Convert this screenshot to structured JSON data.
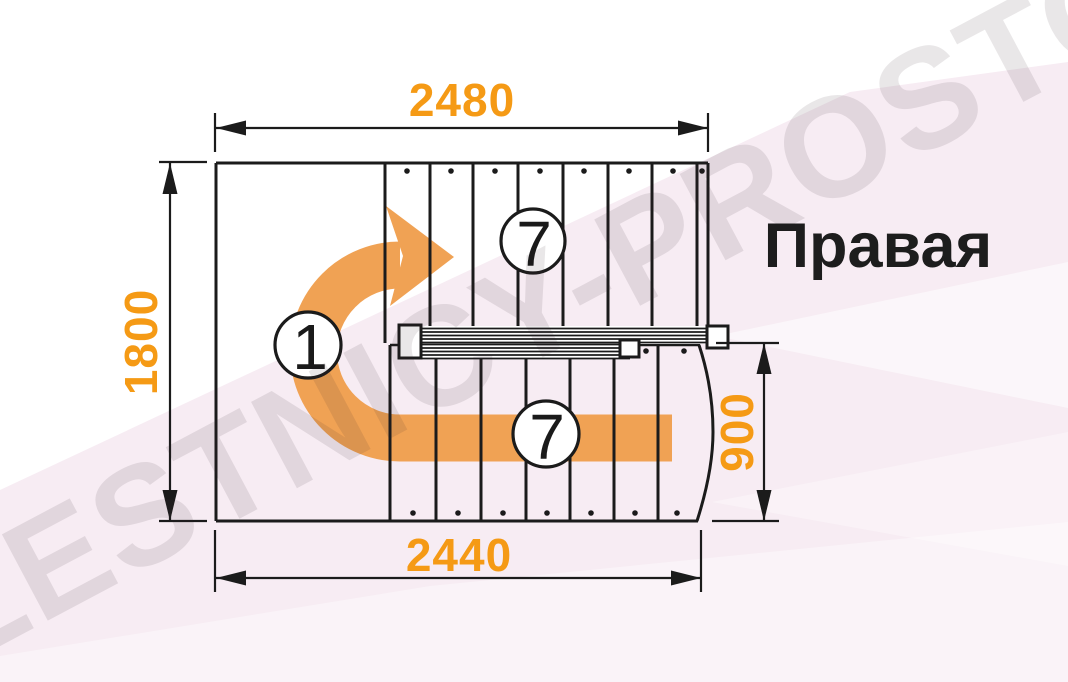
{
  "drawing": {
    "title": "Правая",
    "dimensions": {
      "top": "2480",
      "left": "1800",
      "right": "900",
      "bottom": "2440"
    },
    "markers": {
      "turn": "1",
      "upper_flight_steps": "7",
      "lower_flight_steps": "7"
    },
    "watermark": "LESTNICY-PROSTO.RU",
    "colors": {
      "dimension_text": "#f59a15",
      "turn_arrow": "#f0a254",
      "linework": "#1b1b1b",
      "background_tint": "#f7ecf3"
    }
  }
}
